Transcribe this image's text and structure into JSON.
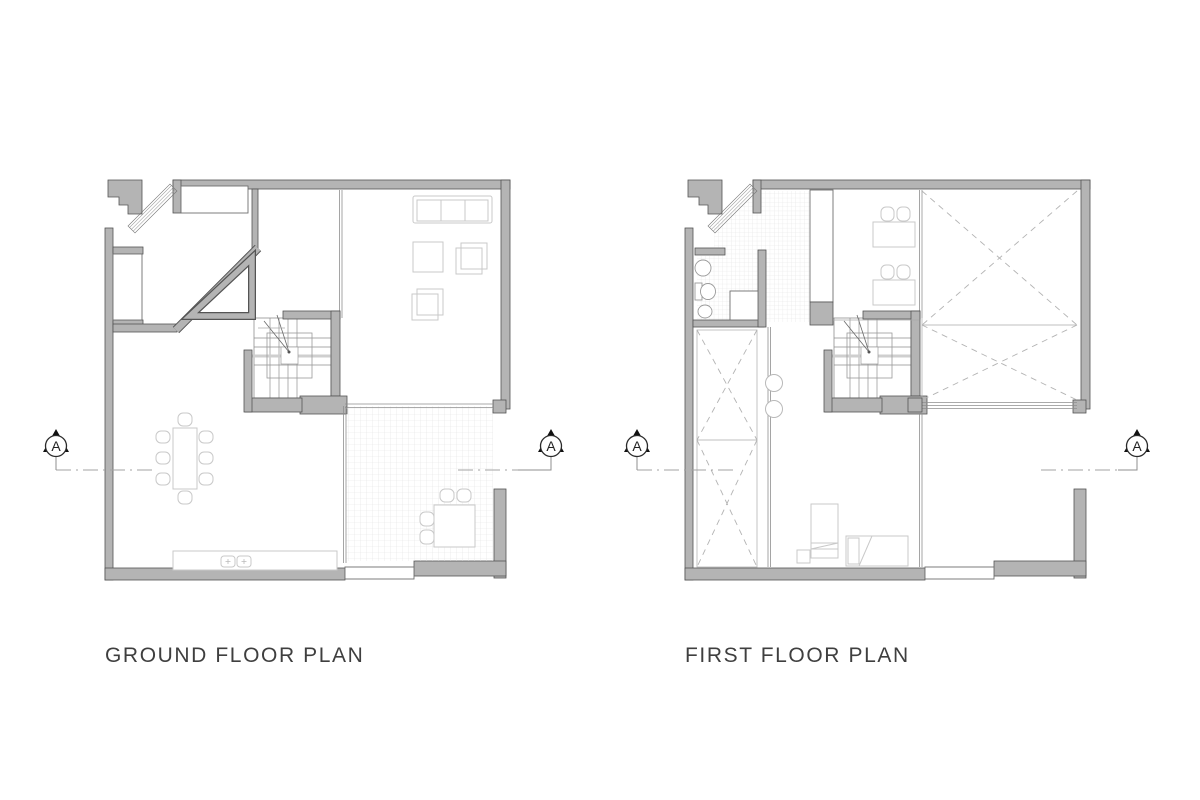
{
  "sheet": {
    "background": "#ffffff"
  },
  "plans": [
    {
      "id": "ground-floor",
      "title": "GROUND FLOOR PLAN",
      "section_markers": [
        {
          "label": "A"
        },
        {
          "label": "A"
        }
      ]
    },
    {
      "id": "first-floor",
      "title": "FIRST FLOOR PLAN",
      "section_markers": [
        {
          "label": "A"
        },
        {
          "label": "A"
        }
      ]
    }
  ],
  "colors": {
    "wall-fill": "#b4b4b4",
    "wall-stroke": "#545454",
    "line-dark": "#6e6e6e",
    "furniture": "#c9c9c9",
    "tile-line": "#e2e2e2",
    "dash-x": "#b3b3b3",
    "section-line": "#a3a3a3",
    "marker": "#111111",
    "title": "#3f3f3f"
  }
}
